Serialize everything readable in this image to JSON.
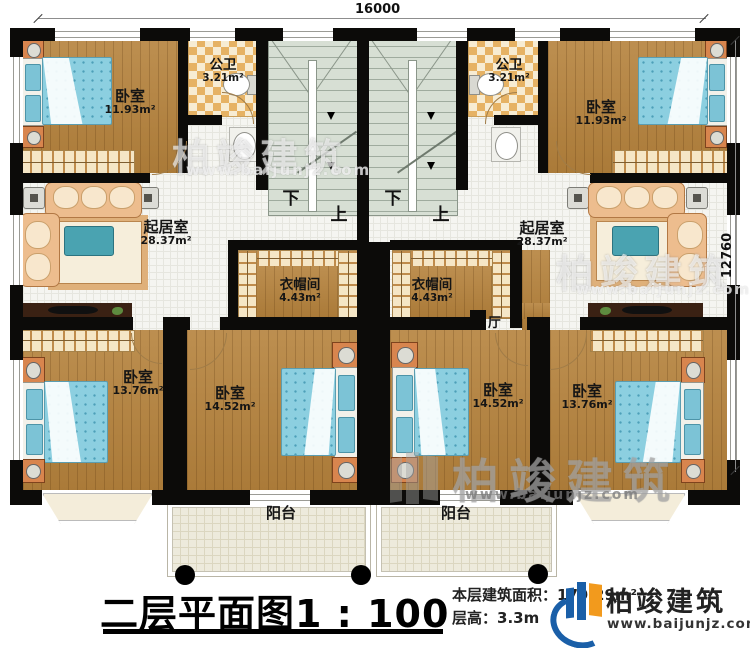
{
  "dimensions": {
    "top": "16000",
    "right": "12760"
  },
  "rooms": {
    "bedroom_tl": {
      "name": "卧室",
      "area": "11.93m²"
    },
    "bedroom_tr": {
      "name": "卧室",
      "area": "11.93m²"
    },
    "bath_l": {
      "name": "公卫",
      "area": "3.21m²"
    },
    "bath_r": {
      "name": "公卫",
      "area": "3.21m²"
    },
    "living_l": {
      "name": "起居室",
      "area": "28.37m²"
    },
    "living_r": {
      "name": "起居室",
      "area": "28.37m²"
    },
    "cloak_l": {
      "name": "衣帽间",
      "area": "4.43m²"
    },
    "cloak_r": {
      "name": "衣帽间",
      "area": "4.43m²"
    },
    "bedroom_bl": {
      "name": "卧室",
      "area": "13.76m²"
    },
    "bedroom_bml": {
      "name": "卧室",
      "area": "14.52m²"
    },
    "bedroom_bmr": {
      "name": "卧室",
      "area": "14.52m²"
    },
    "bedroom_br": {
      "name": "卧室",
      "area": "13.76m²"
    },
    "balcony_l": {
      "name": "阳台"
    },
    "balcony_r": {
      "name": "阳台"
    },
    "hall": {
      "name": "厅"
    }
  },
  "stairs": {
    "down": "下",
    "up": "上"
  },
  "footer": {
    "title": "二层平面图",
    "scale": "1 : 100",
    "area_label": "本层建筑面积：",
    "area_value": "179.29m²",
    "floor_height_label": "层高：",
    "floor_height_value": "3.3m"
  },
  "brand": {
    "name": "柏竣建筑",
    "website": "www.baijunjz.com"
  },
  "watermark": {
    "text": "柏竣建筑",
    "url": "www.baijunjz.com"
  },
  "colors": {
    "wall": "#0c0b09",
    "wood": "#b5823c",
    "tile": "#f5f5f1",
    "stair": "#d7dfd4",
    "checker": "#e6b264",
    "balcony": "#edeadc",
    "bed": "#8ccfe0",
    "brand_blue": "#1a5fa8",
    "brand_orange": "#f29a1d"
  }
}
